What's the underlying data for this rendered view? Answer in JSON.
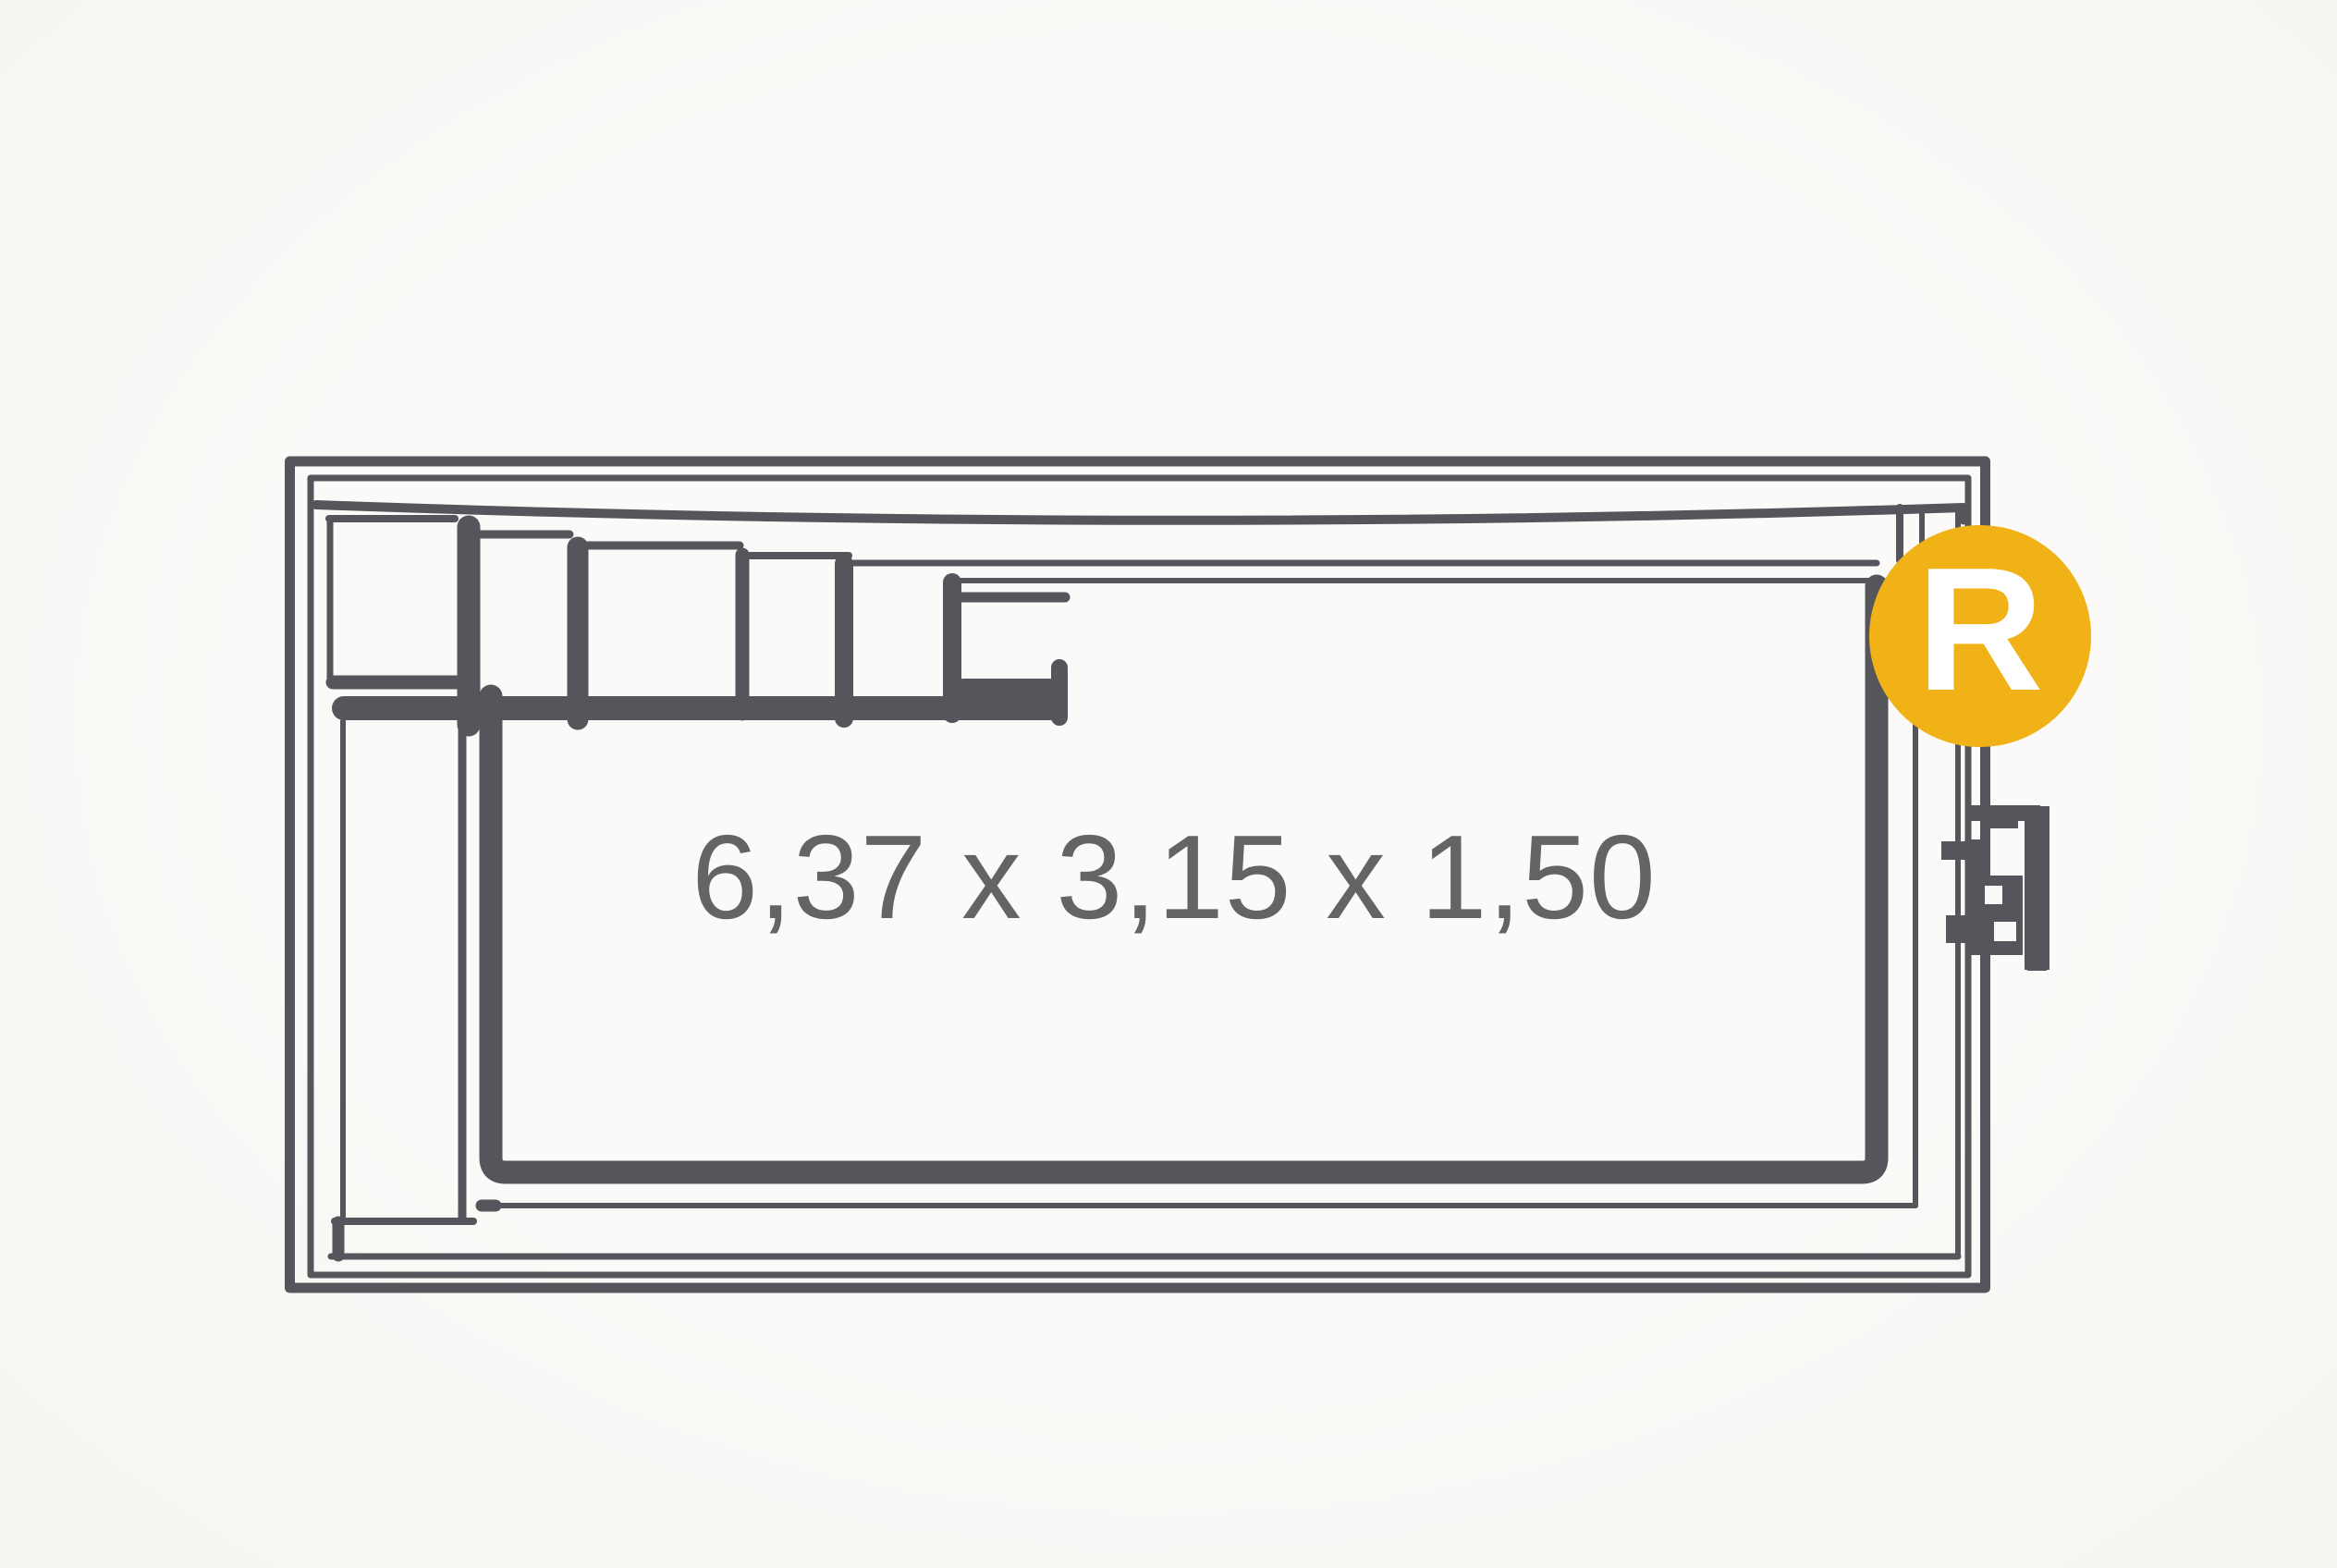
{
  "page": {
    "background_color": "#FAF9F6",
    "paper_color": "#FBFAF8"
  },
  "drawing": {
    "type": "swimming-pool-plan-sketch",
    "line_color": "#55565B",
    "dimensions_label": "6,37 x 3,15 x 1,50",
    "dimensions_label_color": "#646464",
    "badge": {
      "letter": "R",
      "background_color": "#F0B217",
      "letter_color": "#FFFFFF"
    }
  }
}
